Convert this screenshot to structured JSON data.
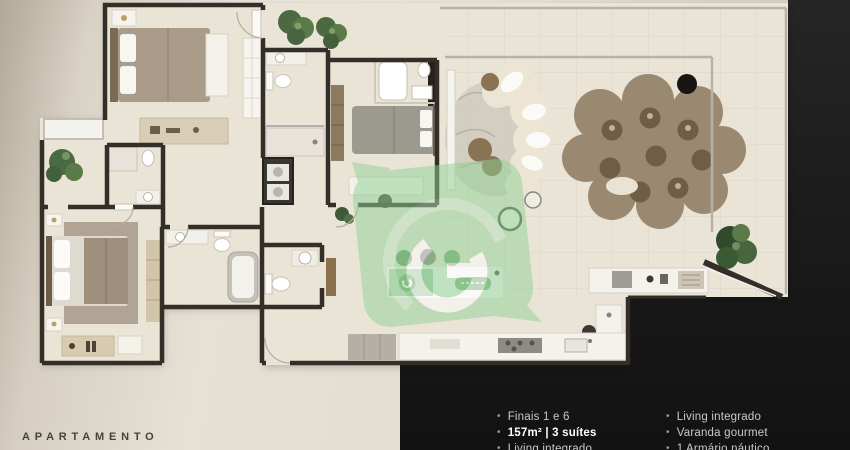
{
  "palette": {
    "wall": "#332e28",
    "floor": "#eae4d7",
    "watermark_green": "#8ed194",
    "panel_black": "#1d1d1d",
    "label_text": "#46423a",
    "feature_text": "#c9c9c9",
    "feature_bold_text": "#ffffff",
    "plant_green": "#4f6a45",
    "rug_brown": "#9a8970"
  },
  "caption": {
    "label": "APARTAMENTO"
  },
  "features": {
    "bullet": "•",
    "left": [
      {
        "text": "Finais 1 e 6"
      },
      {
        "text": "157m² | 3 suítes"
      },
      {
        "text": "Living integrado"
      }
    ],
    "right": [
      {
        "text": "Living integrado"
      },
      {
        "text": "Varanda gourmet"
      },
      {
        "text": "1 Armário náutico"
      }
    ]
  },
  "watermark": {
    "icon": "g-recycle-logo"
  }
}
